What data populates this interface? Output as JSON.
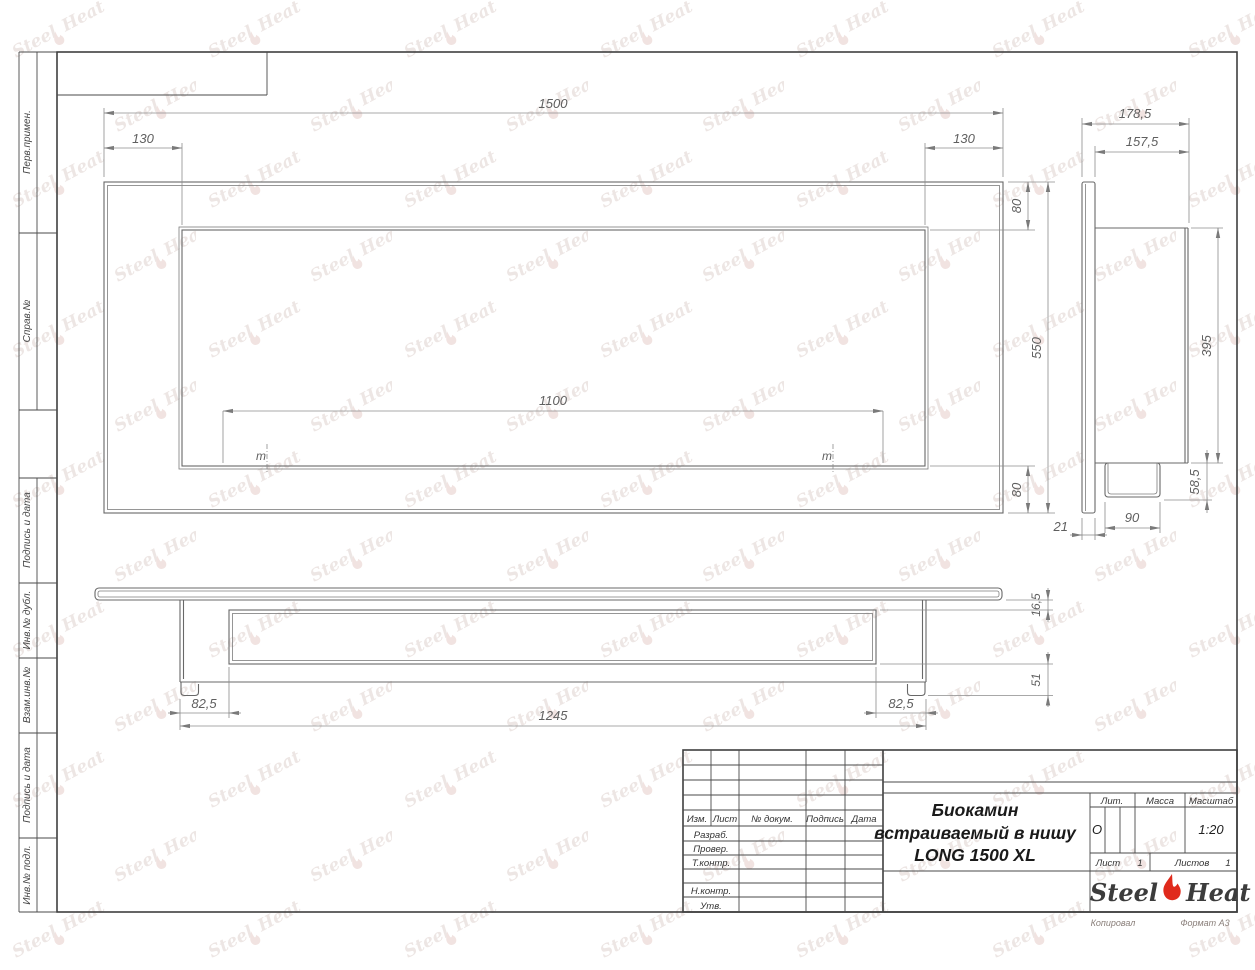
{
  "watermark": {
    "steel": "Steel",
    "heat": "Heat"
  },
  "left_strip": {
    "cells": [
      {
        "label": "Перв.примен."
      },
      {
        "label": "Справ.№"
      },
      {
        "label": "Подпись и дата"
      },
      {
        "label": "Инв.№ дубл."
      },
      {
        "label": "Взам.инв.№"
      },
      {
        "label": "Подпись и дата"
      },
      {
        "label": "Инв.№ подл."
      }
    ]
  },
  "views": {
    "front": {
      "dim_width_total": "1500",
      "dim_offset_left": "130",
      "dim_offset_right": "130",
      "dim_top_margin": "80",
      "dim_height_total": "550",
      "dim_bottom_margin": "80",
      "dim_mount_span": "1100",
      "mount_mark": "m"
    },
    "side": {
      "dim_depth_total": "178,5",
      "dim_depth_body": "157,5",
      "dim_box_height": "395",
      "dim_burner_drop": "58,5",
      "dim_panel_thickness": "21",
      "dim_burner_depth": "90"
    },
    "bottom": {
      "dim_panel_recess": "16,5",
      "dim_foot_height": "51",
      "dim_inset_left": "82,5",
      "dim_body_width": "1245",
      "dim_inset_right": "82,5"
    }
  },
  "title_block": {
    "revision_header": {
      "izm": "Изм.",
      "list": "Лист",
      "doc": "№ докум.",
      "sign": "Подпись",
      "date": "Дата"
    },
    "rows": {
      "developed": "Разраб.",
      "checked": "Провер.",
      "tcontrol": "Т.контр.",
      "ncontrol": "Н.контр.",
      "approved": "Утв."
    },
    "title_line1": "Биокамин",
    "title_line2": "встраиваемый в нишу",
    "title_line3": "LONG 1500 XL",
    "lit_header": "Лит.",
    "mass_header": "Масса",
    "scale_header": "Масштаб",
    "lit_value": "О",
    "scale_value": "1:20",
    "sheet_label": "Лист",
    "sheet_value": "1",
    "sheets_label": "Листов",
    "sheets_value": "1",
    "logo": {
      "steel": "Steel",
      "heat": "Heat"
    }
  },
  "footer": {
    "copied": "Копировал",
    "format": "Формат А3"
  }
}
